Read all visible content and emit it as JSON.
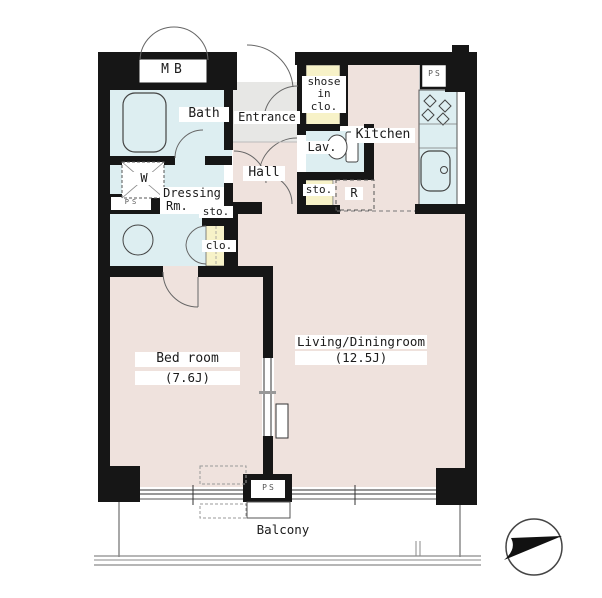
{
  "plan": {
    "rooms": {
      "mb": "MB",
      "bath": "Bath",
      "entrance": "Entrance",
      "shoes_closet": {
        "line1": "shose",
        "line2": "in",
        "line3": "clo."
      },
      "lav": "Lav.",
      "kitchen": "Kitchen",
      "hall": "Hall",
      "dressing": {
        "line1": "Dressing",
        "line2": "Rm."
      },
      "washer": "W",
      "storage_hall": "sto.",
      "storage_kitchen": "sto.",
      "closet": "clo.",
      "fridge": "R",
      "ps_top": "PS",
      "ps_left": "PS",
      "ps_bottom": "PS",
      "bedroom": {
        "name": "Bed room",
        "size": "(7.6J)"
      },
      "living": {
        "name": "Living/Diningroom",
        "size": "(12.5J)"
      },
      "balcony": "Balcony"
    },
    "colors": {
      "wall": "#161616",
      "wet_area": "#ddeef1",
      "floor": "#efe2dd",
      "closet_fill": "#f7f2c8",
      "entrance_floor": "#e7e7e5",
      "line": "#555555"
    }
  }
}
